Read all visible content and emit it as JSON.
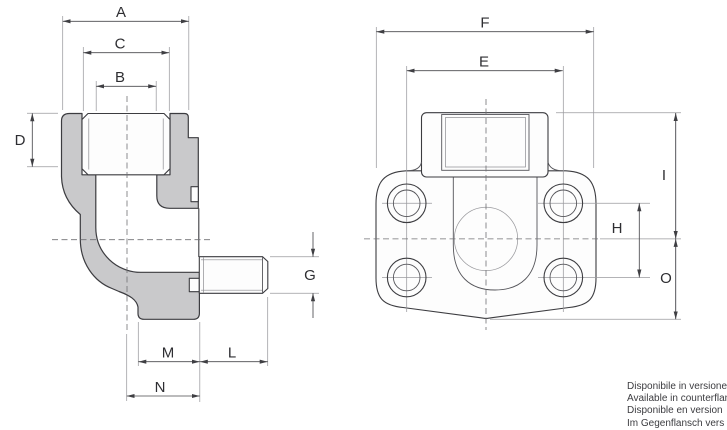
{
  "dims": {
    "side": {
      "A": "A",
      "B": "B",
      "C": "C",
      "D": "D",
      "G": "G",
      "M": "M",
      "L": "L",
      "N": "N"
    },
    "front": {
      "F": "F",
      "E": "E",
      "H": "H",
      "I": "I",
      "O": "O"
    }
  },
  "footer": {
    "lines": [
      "Disponibile in versione",
      "Available in counterflan",
      "Disponible en version",
      "Im Gegenflansch vers"
    ]
  },
  "colors": {
    "section_fill": "#c9c9cb",
    "outline": "#3c3c40",
    "thin_line": "#9a9a9e",
    "dim_line": "#4a4a4e",
    "text": "#2e2e32",
    "background": "#ffffff"
  }
}
